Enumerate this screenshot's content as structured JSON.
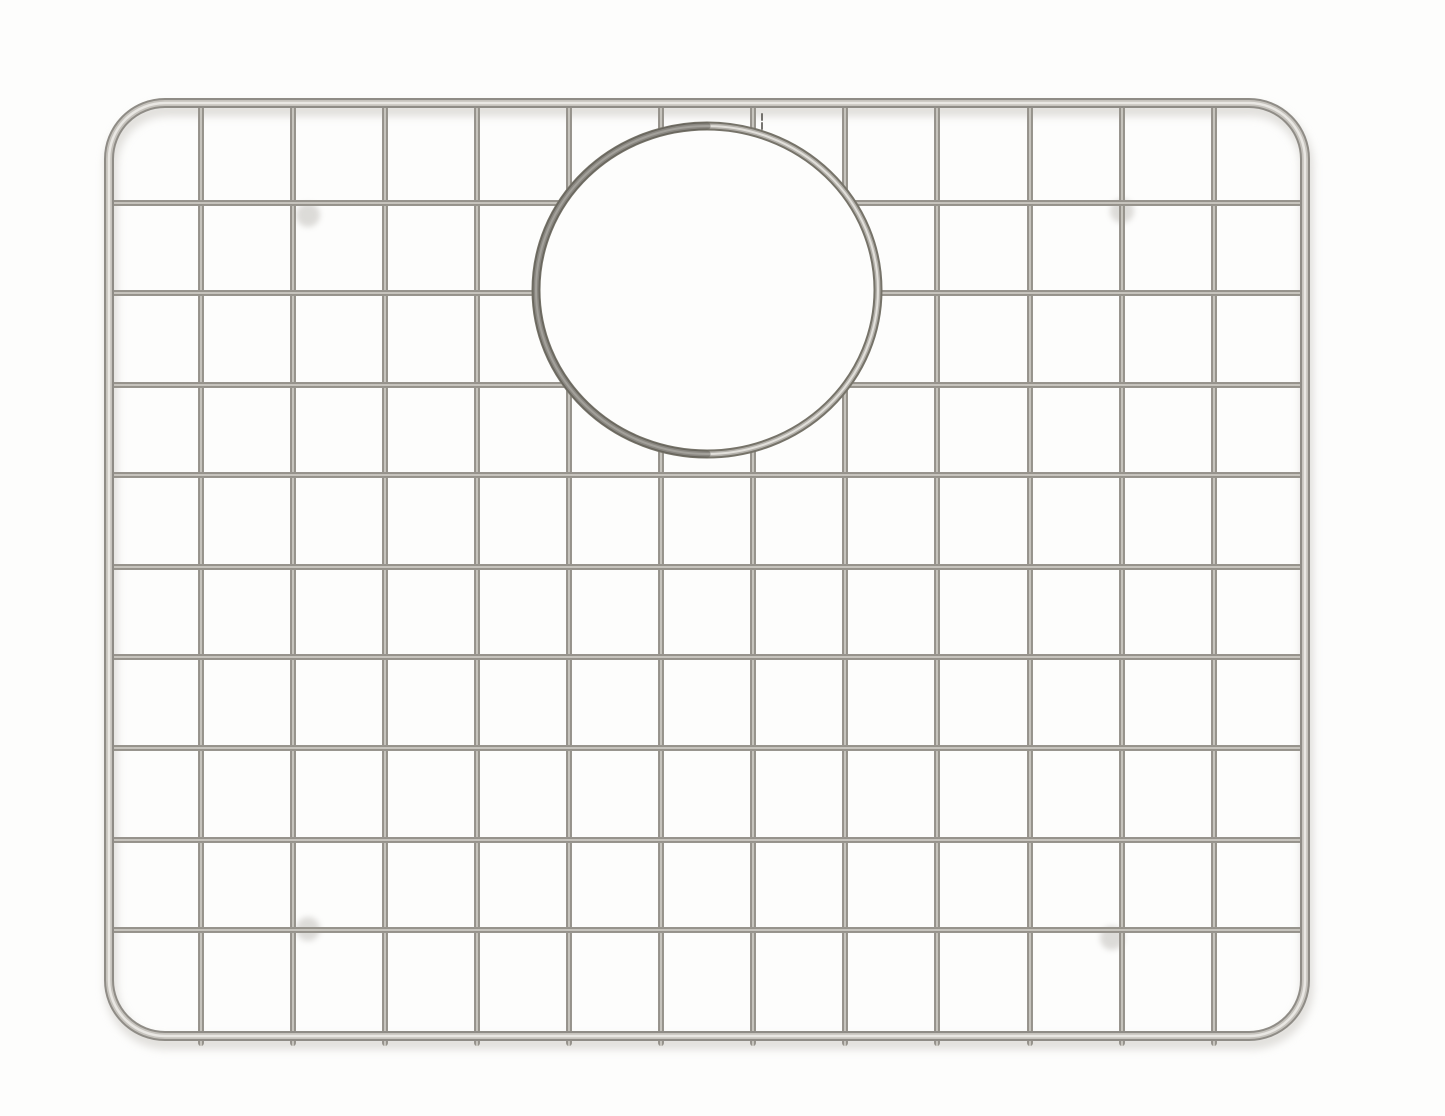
{
  "meta": {
    "type": "product-photograph",
    "subject": "Stainless steel wire sink-bottom grid with round drain opening on a white background",
    "background_color": "#fdfdfc"
  },
  "canvas": {
    "width": 1445,
    "height": 1116
  },
  "grid": {
    "frame": {
      "left": 109,
      "top": 103,
      "right": 1305,
      "bottom": 1036,
      "corner_radius": 56,
      "thickness": 10
    },
    "wire_thickness": 6,
    "wire_overshoot_bottom": 10,
    "vertical_wires_x": [
      201,
      293,
      385,
      477,
      569,
      661,
      753,
      845,
      937,
      1030,
      1122,
      1214
    ],
    "horizontal_wires_y": [
      203,
      293,
      385,
      475,
      567,
      657,
      748,
      840,
      930
    ],
    "drain_opening": {
      "cx": 707,
      "cy": 290,
      "rx": 171,
      "ry": 164,
      "ring_thickness": 9,
      "mask_inset": 3
    },
    "feet": [
      {
        "x": 308,
        "y": 215
      },
      {
        "x": 1122,
        "y": 211
      },
      {
        "x": 308,
        "y": 929
      },
      {
        "x": 1112,
        "y": 938
      }
    ],
    "foot_radius": 12,
    "blemish": {
      "x": 762,
      "y_start": 114,
      "y_end": 129
    },
    "shadow": {
      "dx": 2,
      "dy": 7,
      "extra_width": 2,
      "opacity": 0.85
    },
    "colors": {
      "wire_edge": "#a09d97",
      "wire_shade": "#8a877f",
      "wire_mid": "#e0ddd7",
      "frame_outer": "#8f8c86",
      "frame_mid": "#c6c3bd",
      "frame_core": "#e9e7e3",
      "ring_outer": "#767369",
      "ring_mid": "#b4b1ab",
      "ring_core": "#e2e0db",
      "ring_shade": "#57544e",
      "shadow": "#d9d7d3",
      "foot": "#b5b2ad",
      "blemish": "#55534e"
    }
  }
}
